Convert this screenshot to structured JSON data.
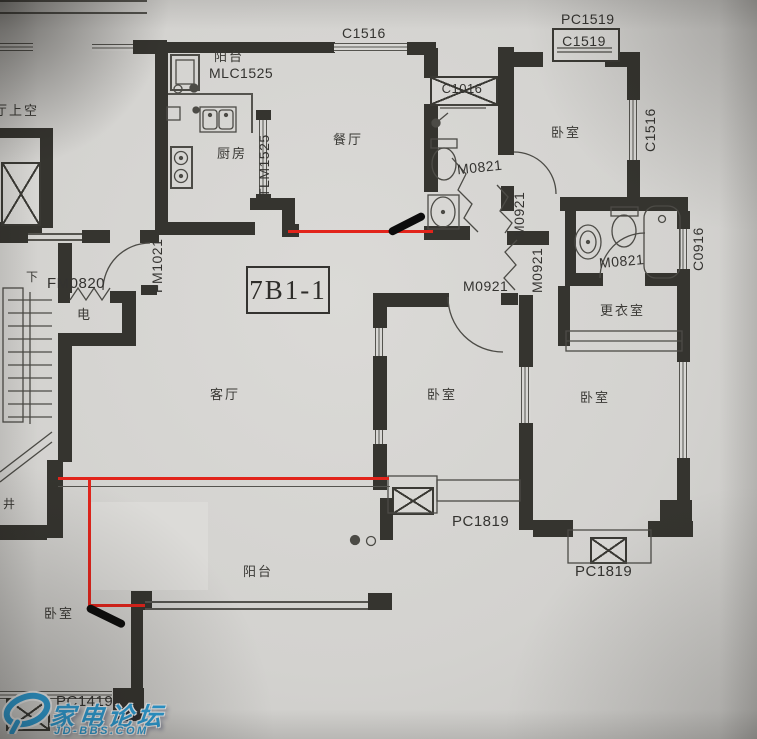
{
  "unit_label": "7B1-1",
  "rooms": {
    "living": "客厅",
    "dining": "餐厅",
    "kitchen": "厨房",
    "balcony_top": "阳台",
    "balcony_bottom": "阳台",
    "bedroom_top_right": "卧室",
    "bedroom_middle": "卧室",
    "bedroom_right": "卧室",
    "bedroom_bottom_left": "卧室",
    "dressing_room": "更衣室",
    "electric_meter": "电",
    "void_above": "厅上空",
    "shaft": "井",
    "stairs_down": "下"
  },
  "codes": {
    "c1516": "C1516",
    "mlc1525": "MLC1525",
    "tlm1525": "TLM1525",
    "c1016": "C1016",
    "pc1519": "PC1519",
    "c1519": "C1519",
    "m0821": "M0821",
    "m0921": "M0921",
    "c0916": "C0916",
    "fm0820": "FM0820",
    "fm1021": "FM1021",
    "pc1819": "PC1819",
    "pc1419": "PC1419"
  },
  "annotations": {
    "red_line_color": "#e2241b",
    "marker_color": "#0c0c0c"
  },
  "watermark": {
    "site_name": "家电论坛",
    "site_url": "JD-BBS.COM",
    "brand_color": "#2d9fd8"
  },
  "palette": {
    "paper": "#d6d5d2",
    "wall": "#35342f",
    "thin_line": "#55544f"
  }
}
